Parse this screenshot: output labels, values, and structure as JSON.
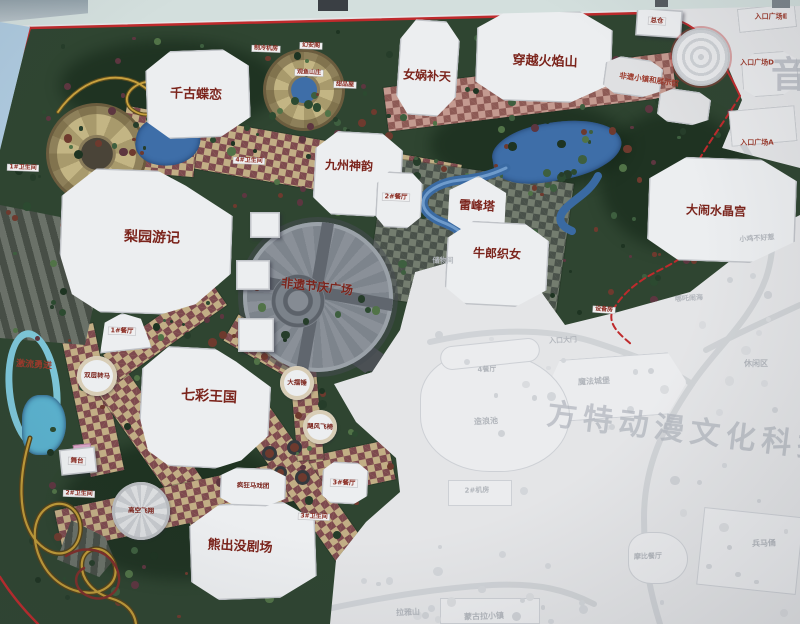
{
  "photo": {
    "subject": "Photographed theme park master-plan map signboard (Fantawild Oriental Heritage style park)",
    "watermark_park_name": "方特动漫文化科技",
    "watermark_right_edge": "音"
  },
  "map": {
    "colors": {
      "border_red": "#bf2a2c",
      "vegetation_green": "#2f4531",
      "path_tan": "#c2ae85",
      "path_maroon": "#7e4a4e",
      "water_blue": "#3a6aa2",
      "plaza_grey": "#848a92",
      "faded_base": "#e4e5e7",
      "label_red": "#7b241c"
    },
    "labels": [
      {
        "name": "attraction-qiangudielian",
        "text": "千古蝶恋",
        "x": 196,
        "y": 95,
        "fs": 13,
        "rot": 2,
        "style": "big"
      },
      {
        "name": "attraction-nuwabutian",
        "text": "女娲补天",
        "x": 427,
        "y": 76,
        "fs": 12,
        "rot": 3,
        "style": "big"
      },
      {
        "name": "attraction-chuanyuehuoyanshan",
        "text": "穿越火焰山",
        "x": 545,
        "y": 62,
        "fs": 13,
        "rot": 2,
        "style": "big"
      },
      {
        "name": "attraction-jiuzhoushenyun",
        "text": "九州神韵",
        "x": 349,
        "y": 166,
        "fs": 12,
        "rot": 2,
        "style": "big"
      },
      {
        "name": "attraction-leifengta",
        "text": "雷峰塔",
        "x": 477,
        "y": 206,
        "fs": 12,
        "rot": 3,
        "style": "big"
      },
      {
        "name": "attraction-danaoshuijinggong",
        "text": "大闹水晶宫",
        "x": 716,
        "y": 211,
        "fs": 12,
        "rot": 2,
        "style": "big"
      },
      {
        "name": "attraction-niulangzhinv",
        "text": "牛郎织女",
        "x": 497,
        "y": 254,
        "fs": 12,
        "rot": 2,
        "style": "big"
      },
      {
        "name": "attraction-liyuanyouji",
        "text": "梨园游记",
        "x": 152,
        "y": 238,
        "fs": 14,
        "rot": 2,
        "style": "big"
      },
      {
        "name": "plaza-feiyijieqingguangchang",
        "text": "非遗节庆广场",
        "x": 317,
        "y": 287,
        "fs": 12,
        "rot": 6,
        "style": "big"
      },
      {
        "name": "attraction-qicaiwangguo",
        "text": "七彩王国",
        "x": 209,
        "y": 397,
        "fs": 14,
        "rot": 3,
        "style": "big"
      },
      {
        "name": "attraction-xiongchumojuchang",
        "text": "熊出没剧场",
        "x": 240,
        "y": 547,
        "fs": 13,
        "rot": 3,
        "style": "big"
      },
      {
        "name": "ride-jiliuyongjin",
        "text": "激流勇进",
        "x": 34,
        "y": 366,
        "fs": 9,
        "rot": 4,
        "style": "darkred"
      },
      {
        "name": "area-feiyixiaozhen",
        "text": "非遗小镇和展示馆",
        "x": 649,
        "y": 80,
        "fs": 7.5,
        "rot": 8,
        "style": "darkred"
      },
      {
        "name": "ride-shuangcengzhuanma",
        "text": "双层转马",
        "x": 97,
        "y": 376,
        "fs": 6.5,
        "rot": 2,
        "style": "small"
      },
      {
        "name": "ride-dabaichui",
        "text": "大摆锤",
        "x": 297,
        "y": 383,
        "fs": 6.5,
        "rot": 2,
        "style": "small"
      },
      {
        "name": "ride-jufengfeiyi",
        "text": "飓风飞椅",
        "x": 320,
        "y": 427,
        "fs": 6.5,
        "rot": 2,
        "style": "small"
      },
      {
        "name": "ride-gaokongfeixiang",
        "text": "高空飞翔",
        "x": 141,
        "y": 511,
        "fs": 6.5,
        "rot": 2,
        "style": "small"
      },
      {
        "name": "ride-fengkuangmaxituan",
        "text": "疯狂马戏团",
        "x": 253,
        "y": 486,
        "fs": 6.5,
        "rot": 2,
        "style": "small"
      },
      {
        "name": "facility-wutai",
        "text": "舞台",
        "x": 77,
        "y": 461,
        "fs": 6.5,
        "rot": 2,
        "style": "chip"
      },
      {
        "name": "facility-canting-1",
        "text": "1#餐厅",
        "x": 122,
        "y": 331,
        "fs": 6.5,
        "rot": 2,
        "style": "chip"
      },
      {
        "name": "facility-canting-2",
        "text": "2#餐厅",
        "x": 396,
        "y": 197,
        "fs": 6.5,
        "rot": 2,
        "style": "chip"
      },
      {
        "name": "facility-canting-3",
        "text": "3#餐厅",
        "x": 344,
        "y": 483,
        "fs": 6.5,
        "rot": 2,
        "style": "chip"
      },
      {
        "name": "facility-weishengjian-1",
        "text": "1#卫生间",
        "x": 23,
        "y": 168,
        "fs": 6,
        "rot": 2,
        "style": "chip"
      },
      {
        "name": "facility-weishengjian-4",
        "text": "4#卫生间",
        "x": 249,
        "y": 161,
        "fs": 6,
        "rot": 2,
        "style": "chip"
      },
      {
        "name": "facility-weishengjian-2",
        "text": "2#卫生间",
        "x": 79,
        "y": 494,
        "fs": 6,
        "rot": 2,
        "style": "chip"
      },
      {
        "name": "facility-weishengjian-3",
        "text": "3#卫生间",
        "x": 314,
        "y": 517,
        "fs": 6,
        "rot": 2,
        "style": "chip"
      },
      {
        "name": "facility-zongcang",
        "text": "总仓",
        "x": 657,
        "y": 21,
        "fs": 6.5,
        "rot": 3,
        "style": "chip"
      },
      {
        "name": "facility-zhilengjifang",
        "text": "制冷机房",
        "x": 266,
        "y": 49,
        "fs": 6,
        "rot": 2,
        "style": "chip"
      },
      {
        "name": "facility-huananage",
        "text": "幻安阁",
        "x": 311,
        "y": 46,
        "fs": 6,
        "rot": 2,
        "style": "chip"
      },
      {
        "name": "facility-guanyushanzhuang",
        "text": "观鱼山庄",
        "x": 309,
        "y": 73,
        "fs": 6,
        "rot": 2,
        "style": "chip"
      },
      {
        "name": "facility-tianpinwu",
        "text": "甜品屋",
        "x": 345,
        "y": 85,
        "fs": 6,
        "rot": 2,
        "style": "chip"
      },
      {
        "name": "facility-shebeifang",
        "text": "设备房",
        "x": 604,
        "y": 310,
        "fs": 6,
        "rot": 4,
        "style": "chip"
      },
      {
        "name": "facility-chuwujian",
        "text": "储物间",
        "x": 443,
        "y": 261,
        "fs": 7,
        "rot": 0,
        "style": "fade"
      },
      {
        "name": "entrance-plaza-e",
        "text": "入口广场E",
        "x": 771,
        "y": 17,
        "fs": 7,
        "rot": 0,
        "style": "darkred"
      },
      {
        "name": "entrance-plaza-d",
        "text": "入口广场D",
        "x": 757,
        "y": 63,
        "fs": 7,
        "rot": 0,
        "style": "darkred"
      },
      {
        "name": "entrance-plaza-a",
        "text": "入口广场A",
        "x": 757,
        "y": 143,
        "fs": 7,
        "rot": 0,
        "style": "darkred"
      },
      {
        "name": "faded-mofachengbao",
        "text": "魔法城堡",
        "x": 594,
        "y": 382,
        "fs": 8,
        "rot": -3,
        "style": "fade"
      },
      {
        "name": "faded-xiuxianqu",
        "text": "休闲区",
        "x": 756,
        "y": 364,
        "fs": 8,
        "rot": 0,
        "style": "fade"
      },
      {
        "name": "faded-canting-4",
        "text": "4餐厅",
        "x": 487,
        "y": 370,
        "fs": 7,
        "rot": -3,
        "style": "fade"
      },
      {
        "name": "faded-zaolangchi",
        "text": "造浪池",
        "x": 486,
        "y": 422,
        "fs": 8,
        "rot": -3,
        "style": "fade"
      },
      {
        "name": "faded-jifang-2",
        "text": "2#机房",
        "x": 477,
        "y": 491,
        "fs": 7,
        "rot": -2,
        "style": "fade"
      },
      {
        "name": "faded-bingmayong",
        "text": "兵马俑",
        "x": 764,
        "y": 544,
        "fs": 8,
        "rot": -2,
        "style": "fade"
      },
      {
        "name": "faded-mobicanting",
        "text": "摩比餐厅",
        "x": 648,
        "y": 557,
        "fs": 7,
        "rot": -2,
        "style": "fade"
      },
      {
        "name": "faded-xiaojibuhaore",
        "text": "小鸡不好惹",
        "x": 757,
        "y": 239,
        "fs": 7,
        "rot": -4,
        "style": "fade"
      },
      {
        "name": "faded-nezhanaohai",
        "text": "哪吒闹海",
        "x": 689,
        "y": 299,
        "fs": 7,
        "rot": -4,
        "style": "fade"
      },
      {
        "name": "faded-rukoudamen",
        "text": "入口大门",
        "x": 563,
        "y": 341,
        "fs": 7,
        "rot": -3,
        "style": "fade"
      },
      {
        "name": "faded-menggulaxiaozhen",
        "text": "蒙古拉小镇",
        "x": 484,
        "y": 617,
        "fs": 8,
        "rot": -2,
        "style": "fade"
      },
      {
        "name": "faded-layashan",
        "text": "拉雅山",
        "x": 408,
        "y": 613,
        "fs": 8,
        "rot": -2,
        "style": "fade"
      },
      {
        "name": "watermark-park-name",
        "text": "方特动漫文化科技",
        "x": 690,
        "y": 432,
        "fs": 30,
        "rot": 7,
        "style": "wm"
      },
      {
        "name": "watermark-yin",
        "text": "音",
        "x": 792,
        "y": 76,
        "fs": 36,
        "rot": 0,
        "style": "wm"
      }
    ]
  }
}
